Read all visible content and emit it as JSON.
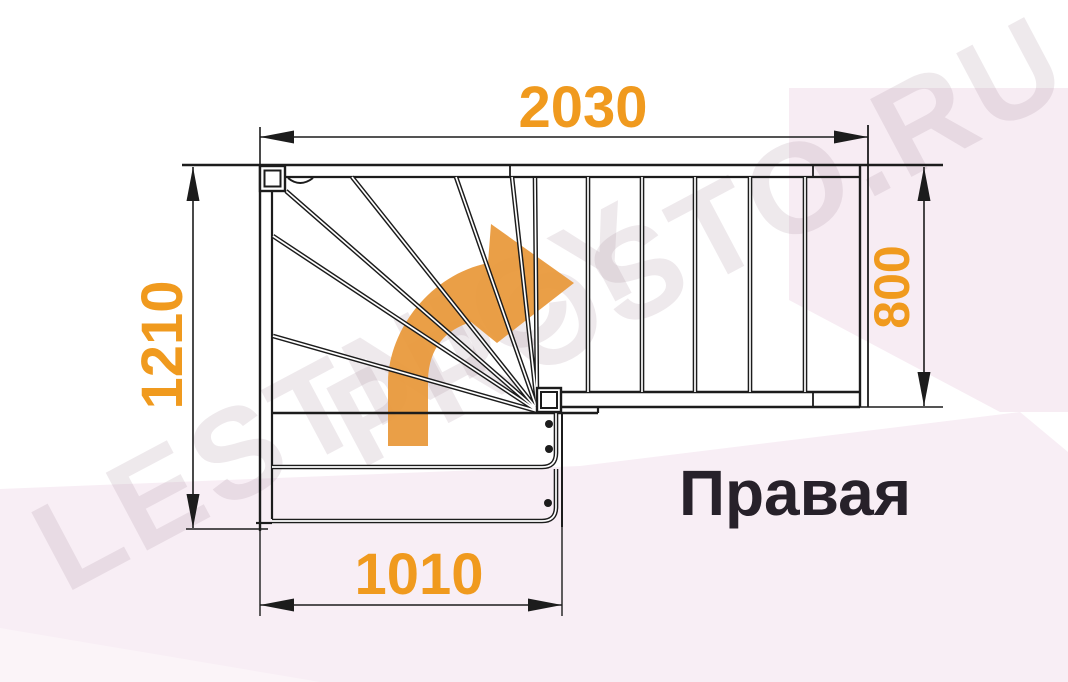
{
  "dimensions": {
    "top_width_mm": "2030",
    "left_height_mm": "1210",
    "right_depth_mm": "800",
    "bottom_width_mm": "1010"
  },
  "labels": {
    "orientation": "Правая"
  },
  "watermark": {
    "line1": "LESTNICY",
    "line2": "PROSTO.RU"
  },
  "icons": {
    "direction_arrow": "curved-right-turn-arrow-icon"
  },
  "colors": {
    "dimension_text": "#F09A1E",
    "direction_arrow": "#E9993B",
    "drawing_lines": "#1C1C1C",
    "orientation_text": "#27212A",
    "background_tint_light": "#F8EEF5",
    "background_tint_corner": "#F7ECF3"
  }
}
